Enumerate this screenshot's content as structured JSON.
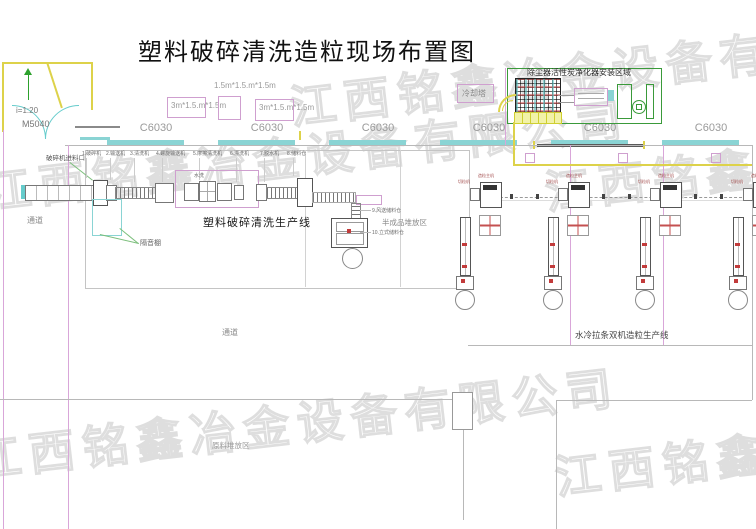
{
  "title": "塑料破碎清洗造粒现场布置图",
  "watermark": "江西铭鑫冶金设备有限公司",
  "entrance": {
    "slope_label": "i=1:20",
    "door_code": "M5040"
  },
  "dimension_labels": {
    "top": "1.5m*1.5.m*1.5m",
    "left": "3m*1.5.m*1.5m",
    "right": "3m*1.5.m*1.5m"
  },
  "column_label": "C6030",
  "dust_area": {
    "title": "除尘器活性炭净化器安装区域",
    "cooling_tower": "冷却塔"
  },
  "wash_line": {
    "name": "塑料破碎清洗生产线",
    "feed_label": "破碎机进料口",
    "water_note": "水洗",
    "equipment": [
      "1.破碎机",
      "2.输送机",
      "3.清洗机",
      "4.螺旋输送机",
      "5.摩擦清洗机",
      "6.漂洗机",
      "7.脱水机",
      "8.储料仓"
    ],
    "side_labels": [
      "9.风送储料仓",
      "10.立式储料仓"
    ]
  },
  "pellet_line": {
    "name": "水冷拉条双机造粒生产线",
    "unit_label_a": "造粒主机",
    "unit_label_b": "切粒机"
  },
  "areas": {
    "semi_storage": "半成品堆放区",
    "raw_storage": "原料堆放区",
    "soundproof": "隔音棚",
    "passage_left": "通道",
    "passage_mid": "通道"
  },
  "colors": {
    "accent_cyan": "#8ad4d4",
    "accent_magenta": "#cf9fcf",
    "accent_yellow": "#ddd24a",
    "accent_green": "#3a9a3a",
    "structure_gray": "#b8b8b8",
    "watermark_gray": "#dedede"
  }
}
